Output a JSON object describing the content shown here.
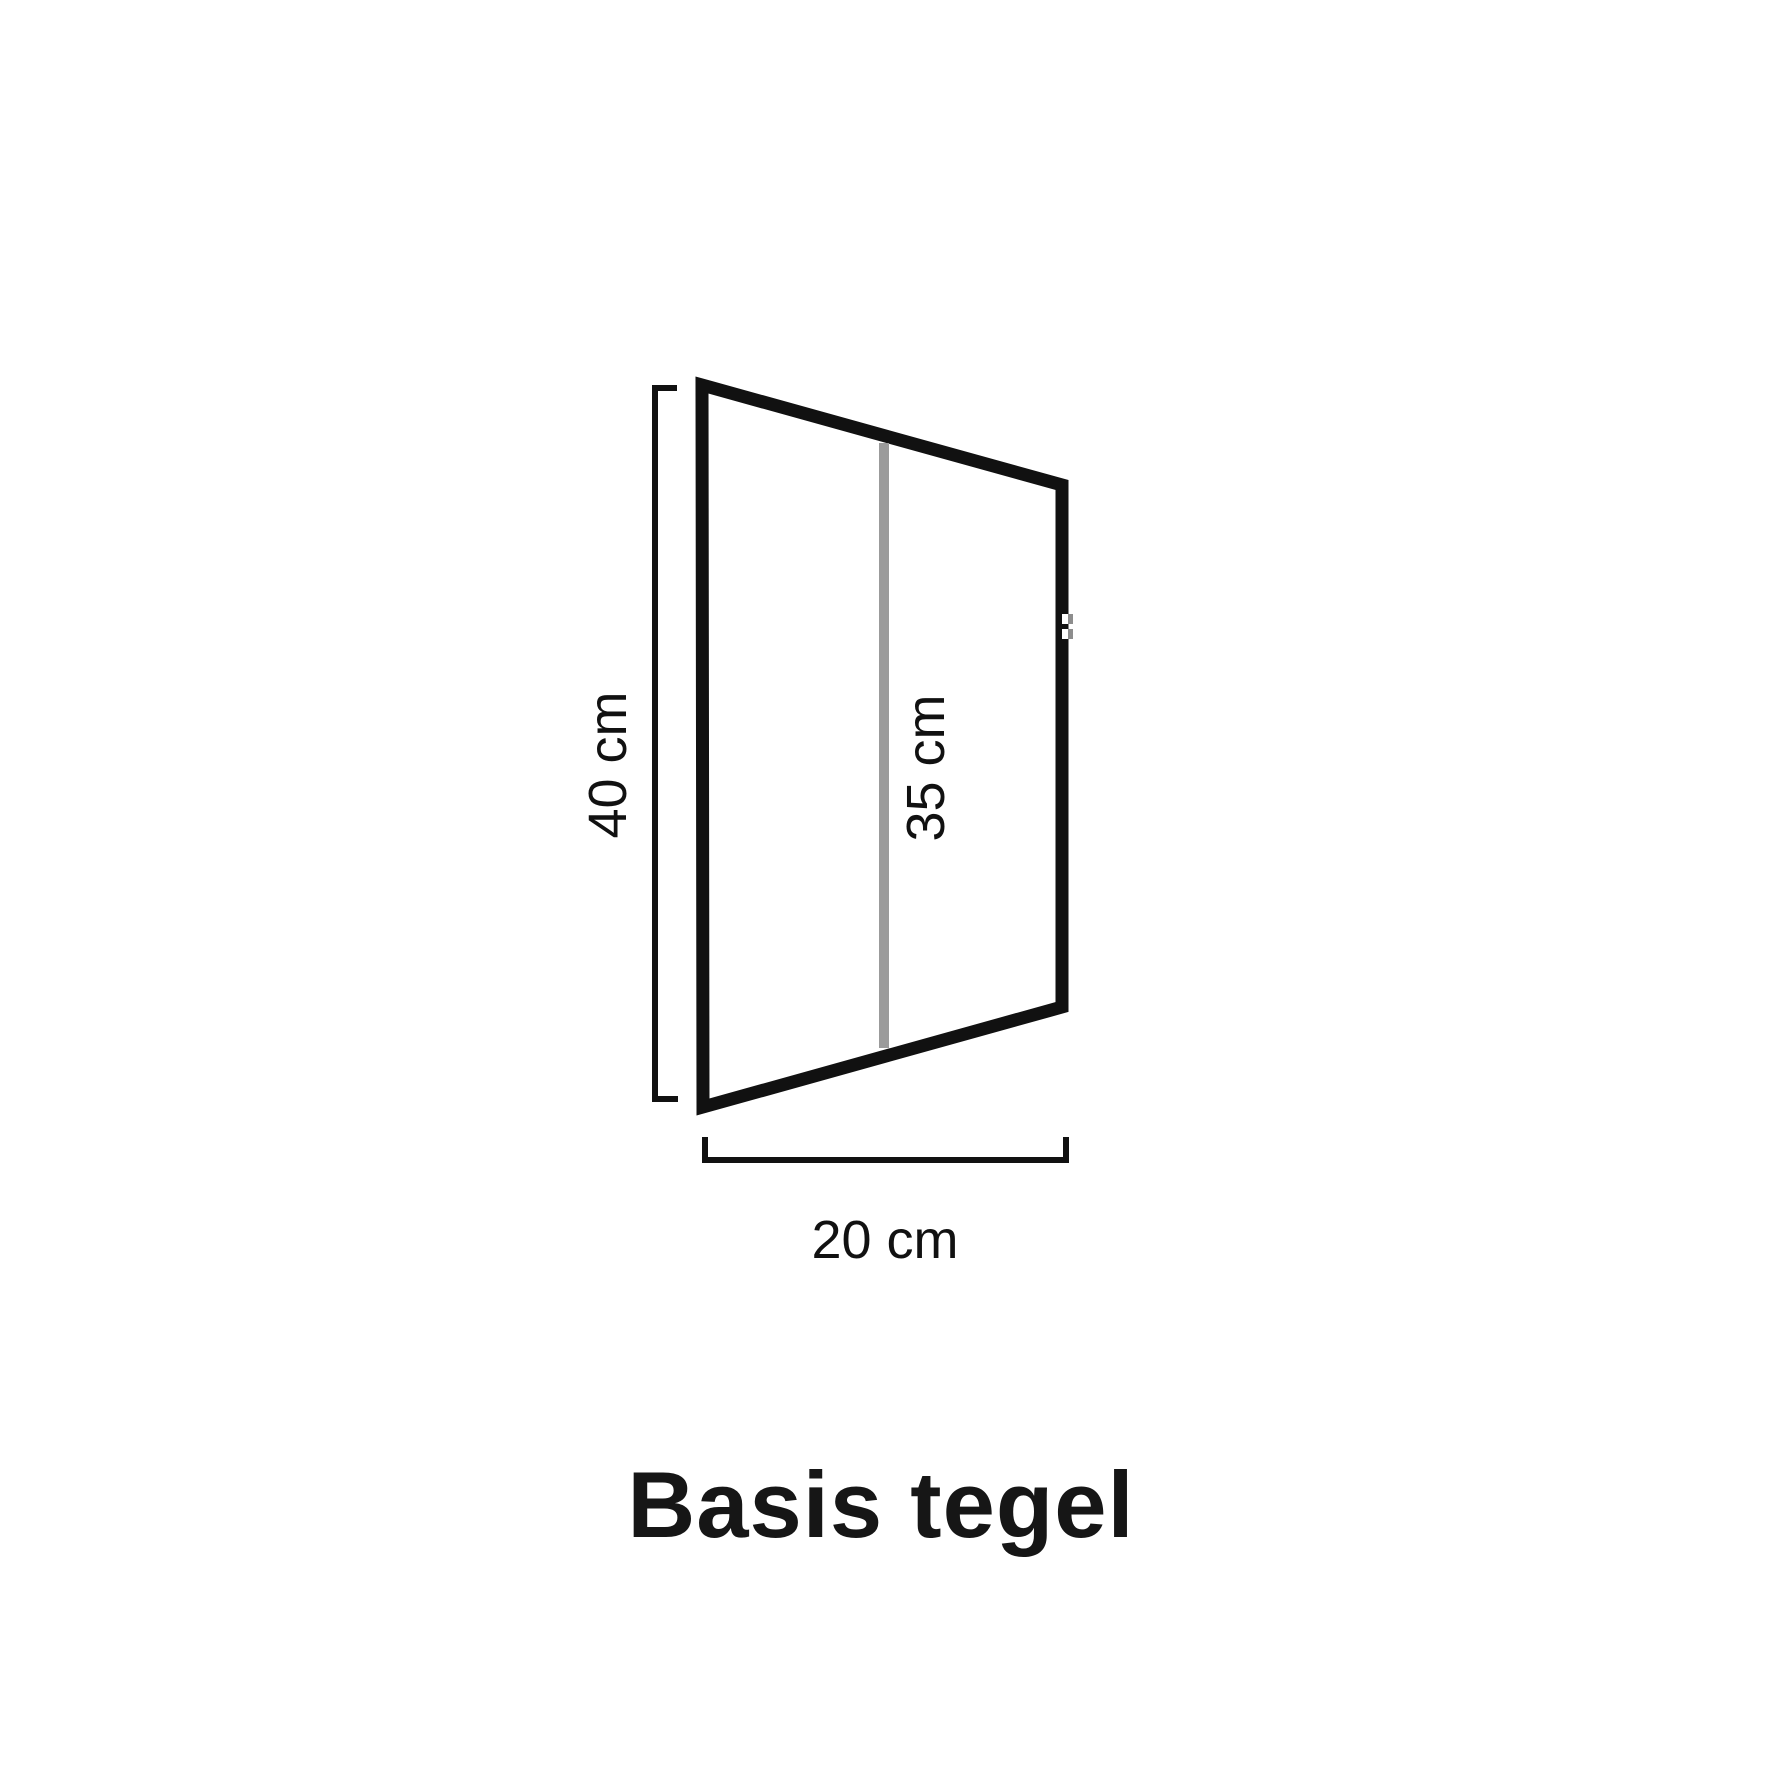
{
  "diagram": {
    "title": "Basis tegel",
    "labels": {
      "left_height": "40 cm",
      "middle_height": "35 cm",
      "bottom_width": "20 cm"
    },
    "colors": {
      "ink": "#111111",
      "measure_gray": "#9b9b9b",
      "background": "#ffffff"
    }
  }
}
